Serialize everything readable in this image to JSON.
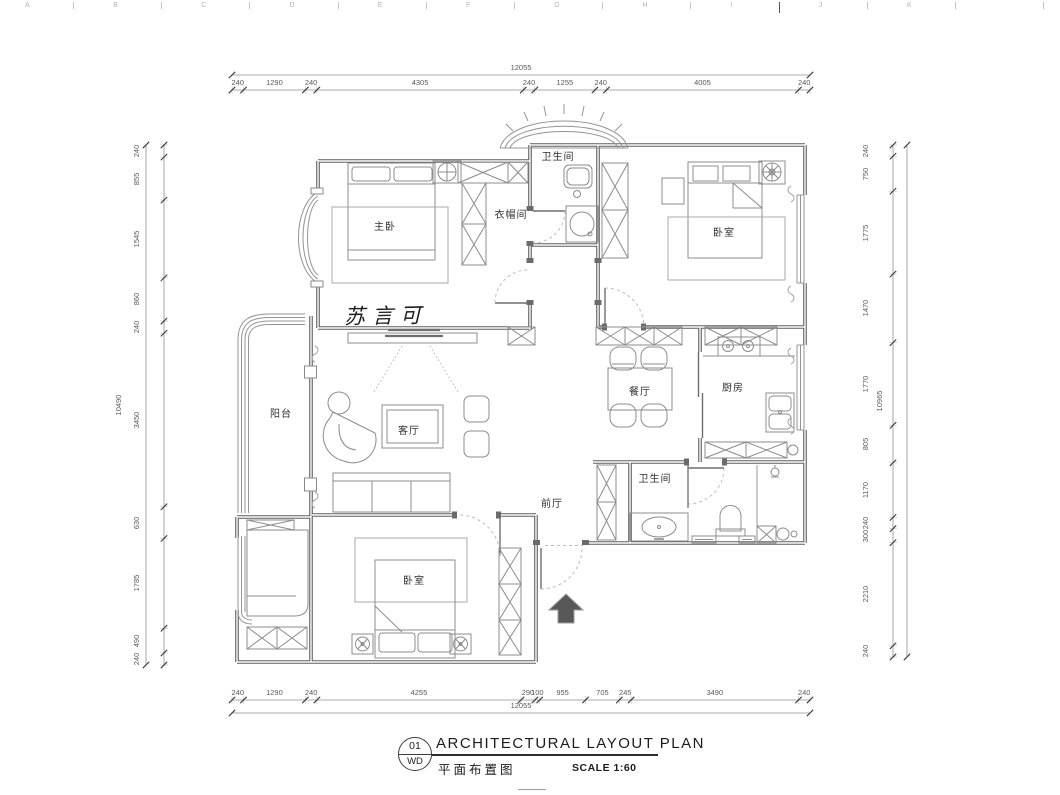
{
  "ruler": {
    "letters": [
      "A",
      "B",
      "C",
      "D",
      "E",
      "F",
      "G",
      "H",
      "I",
      "J",
      "K"
    ]
  },
  "plan": {
    "watermark": "苏言可",
    "rooms": [
      {
        "id": "master-bedroom",
        "label": "主卧"
      },
      {
        "id": "cloakroom",
        "label": "衣帽间"
      },
      {
        "id": "bathroom-top",
        "label": "卫生间"
      },
      {
        "id": "bedroom-2",
        "label": "卧室"
      },
      {
        "id": "balcony",
        "label": "阳台"
      },
      {
        "id": "living-room",
        "label": "客厅"
      },
      {
        "id": "dining-room",
        "label": "餐厅"
      },
      {
        "id": "kitchen",
        "label": "厨房"
      },
      {
        "id": "foyer",
        "label": "前厅"
      },
      {
        "id": "bathroom-2",
        "label": "卫生间"
      },
      {
        "id": "bedroom-3",
        "label": "卧室"
      }
    ]
  },
  "dimensions": {
    "top": {
      "overall": "12055",
      "segments": [
        "240",
        "1290",
        "240",
        "4305",
        "240",
        "1255",
        "240",
        "4005",
        "240"
      ]
    },
    "bottom": {
      "overall": "12055",
      "segments": [
        "240",
        "1290",
        "240",
        "4255",
        "290",
        "100",
        "955",
        "705",
        "245",
        "3490",
        "240"
      ]
    },
    "left": {
      "overall": "10490",
      "segments": [
        "240",
        "855",
        "1545",
        "860",
        "240",
        "3450",
        "630",
        "1785",
        "490",
        "240"
      ]
    },
    "right": {
      "overall": "10965",
      "segments": [
        "240",
        "750",
        "1775",
        "1470",
        "1770",
        "805",
        "1170",
        "240",
        "300",
        "2210",
        "240"
      ]
    }
  },
  "title_block": {
    "sheet_number": "01",
    "sheet_code": "WD",
    "title_en": "ARCHITECTURAL LAYOUT PLAN",
    "title_cn": "平面布置图",
    "scale": "SCALE 1:60"
  }
}
